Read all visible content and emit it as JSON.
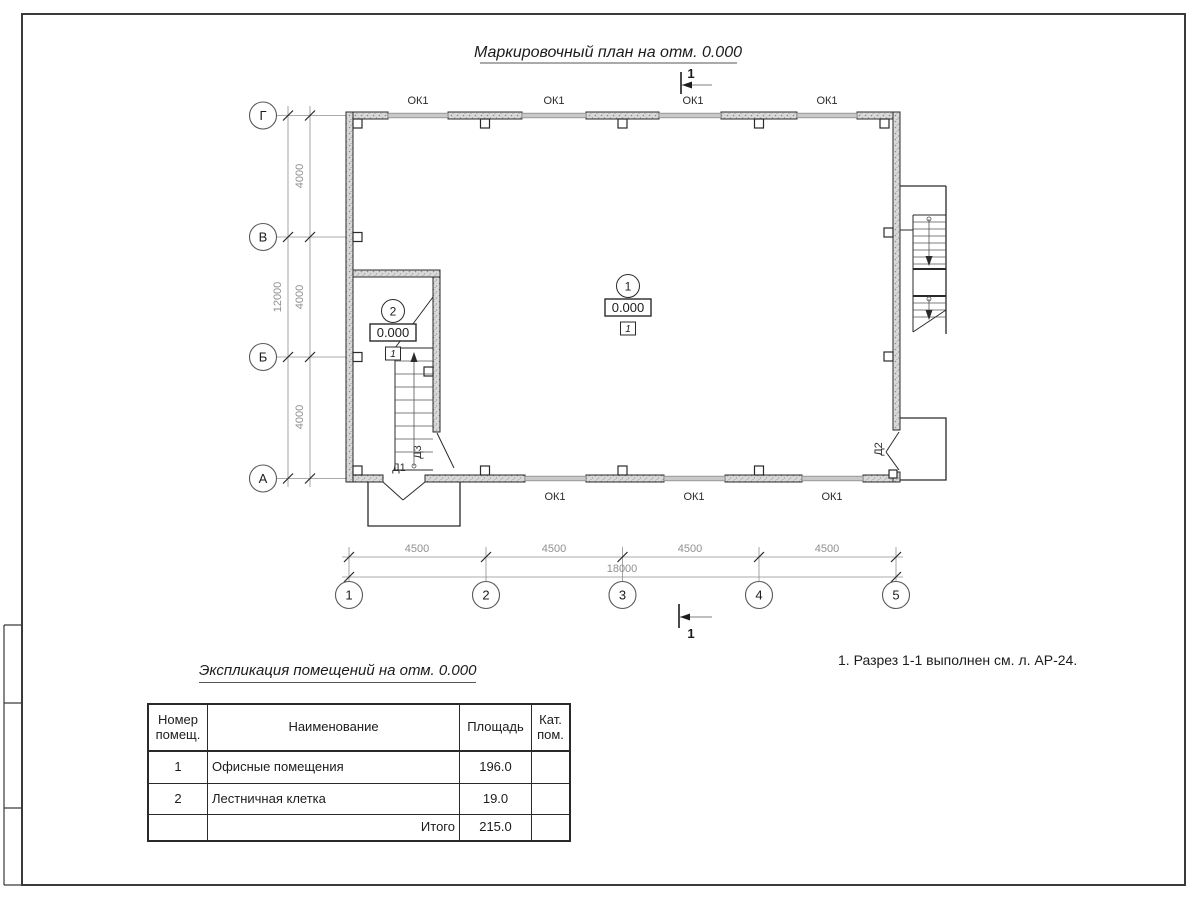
{
  "title": "Маркировочный план на отм. 0.000",
  "plan": {
    "axes_v": [
      "Г",
      "В",
      "Б",
      "А"
    ],
    "axes_h": [
      "1",
      "2",
      "3",
      "4",
      "5"
    ],
    "dims_v": {
      "segments": [
        "4000",
        "4000",
        "4000"
      ],
      "total": "12000"
    },
    "dims_h": {
      "segments": [
        "4500",
        "4500",
        "4500",
        "4500"
      ],
      "total": "18000"
    },
    "window_label": "ОК1",
    "doors": {
      "d1": "Д1",
      "d2": "Д2",
      "d3": "Д3"
    },
    "rooms": [
      {
        "num": "1",
        "elevation": "0.000",
        "finish": "1"
      },
      {
        "num": "2",
        "elevation": "0.000",
        "finish": "1"
      }
    ],
    "section_mark": "1"
  },
  "note": "1. Разрез 1-1 выполнен см. л. АР-24.",
  "table": {
    "title": "Экспликация помещений на отм. 0.000",
    "headers": [
      "Номер помещ.",
      "Наименование",
      "Площадь",
      "Кат. пом."
    ],
    "rows": [
      {
        "num": "1",
        "name": "Офисные помещения",
        "area": "196.0",
        "cat": ""
      },
      {
        "num": "2",
        "name": "Лестничная клетка",
        "area": "19.0",
        "cat": ""
      }
    ],
    "total_label": "Итого",
    "total_area": "215.0"
  },
  "colors": {
    "line": "#2a2a2a",
    "wall_fill": "#d9d9d9",
    "dim_text": "#8f8f8f"
  }
}
